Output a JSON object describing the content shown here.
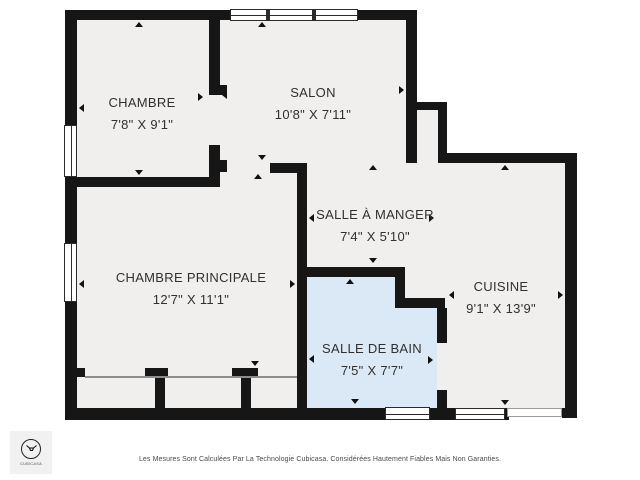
{
  "colors": {
    "wall": "#161616",
    "room_fill": "#f0efed",
    "bathroom_fill": "#dbe9f6",
    "label_text": "#303030",
    "footer_text": "#4a4a4a"
  },
  "rooms": [
    {
      "name": "CHAMBRE",
      "dims": "7'8\" X 9'1\""
    },
    {
      "name": "SALON",
      "dims": "10'8\" X 7'11\""
    },
    {
      "name": "SALLE À MANGER",
      "dims": "7'4\" X 5'10\""
    },
    {
      "name": "CHAMBRE PRINCIPALE",
      "dims": "12'7\" X 11'1\""
    },
    {
      "name": "CUISINE",
      "dims": "9'1\" X 13'9\""
    },
    {
      "name": "SALLE DE BAIN",
      "dims": "7'5\" X 7'7\""
    }
  ],
  "footer": {
    "disclaimer": "Les Mesures Sont Calculées Par La Technologie Cubicasa. Considérées Hautement Fiables Mais Non Garanties."
  },
  "logo": {
    "label": "CUBICASA"
  }
}
